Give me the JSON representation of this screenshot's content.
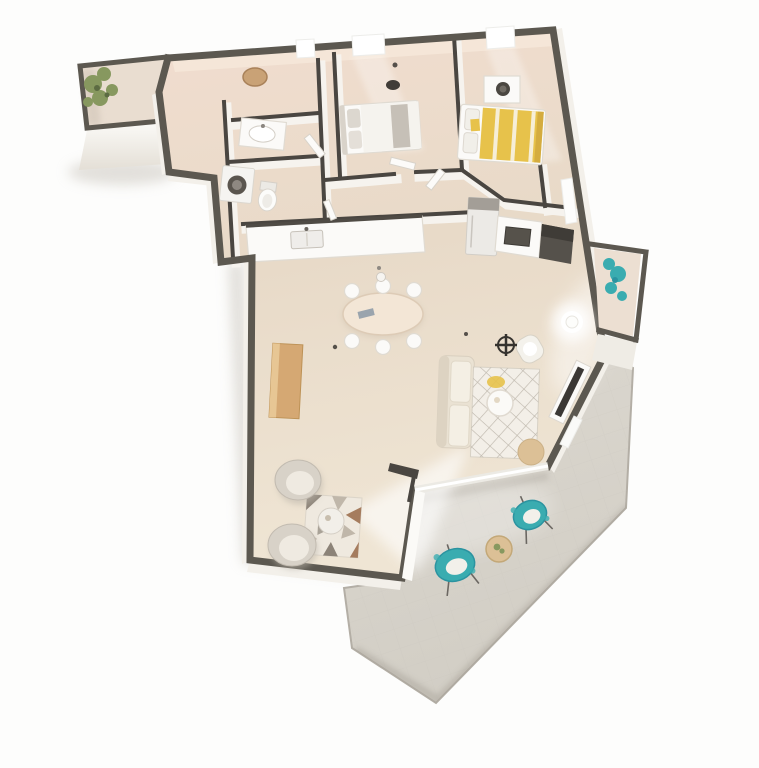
{
  "scene": {
    "kind": "3d-floor-plan-render",
    "view": "isometric top-down apartment visualization",
    "canvas": {
      "width": 759,
      "height": 768
    }
  },
  "palette": {
    "background": "#fdfdfc",
    "floor_top": "#f0ddcf",
    "floor_mid": "#e7d9c7",
    "floor_low": "#f0e6d5",
    "terrace": "#d9d5cc",
    "terrace_edge": "#b3aea5",
    "wall_top": "#5c5850",
    "wall_top_int": "#4a4641",
    "wall_face": "#f3f0ea",
    "white_f": "#fbfaf8",
    "grey_f": "#cec9c1",
    "shadow": "#c7c2ba",
    "bed_yellow": "#e7c24b",
    "bed_yellow_deep": "#cfa63c",
    "teal": "#3aacb0",
    "teal_deep": "#2b93a0",
    "wood": "#d5a873",
    "wood_light": "#e7c694",
    "tan": "#dcc096",
    "plant_green": "#87985f",
    "counter_dark": "#4f4b45",
    "sofa": "#eae2d3",
    "sofa_in": "#f4efe4",
    "rug_base": "#f3efe8",
    "rug_line": "#b5aea2",
    "rug_tri1": "#8c8378",
    "rug_tri2": "#c0b7aa",
    "rug_tri3": "#a57c5e",
    "tv_screen": "#3b3835"
  },
  "objects": {
    "balcony_top_left": [
      "railing walls",
      "green plant"
    ],
    "entry_hall": [
      "open interior doors"
    ],
    "bathroom": [
      "oval mirror",
      "washbasin counter",
      "toilet",
      "washing machine"
    ],
    "bedroom_1": [
      "double bed with grey pillows",
      "window",
      "ceiling light"
    ],
    "bedroom_2": [
      "double bed with yellow striped duvet",
      "dresser with round mirror",
      "window"
    ],
    "kitchen": [
      "white counter with sink",
      "fridge",
      "dark sink counter",
      "dark cooktop block"
    ],
    "living_room": [
      "oval dining table",
      "six dining chairs",
      "pendant lamp",
      "sofa",
      "diamond lattice rug",
      "round coffee table",
      "armchair",
      "ceiling fan",
      "tv cabinet with screen",
      "glowing floor lamp",
      "wooden sideboard",
      "rattan pouf",
      "two round lounge chairs",
      "geometric triangle rug",
      "round side table",
      "sunlight patch"
    ],
    "balcony_right": [
      "railing walls",
      "teal plant"
    ],
    "terrace": [
      "paved floor",
      "two teal lounge chairs",
      "round tan table with small plant"
    ]
  }
}
